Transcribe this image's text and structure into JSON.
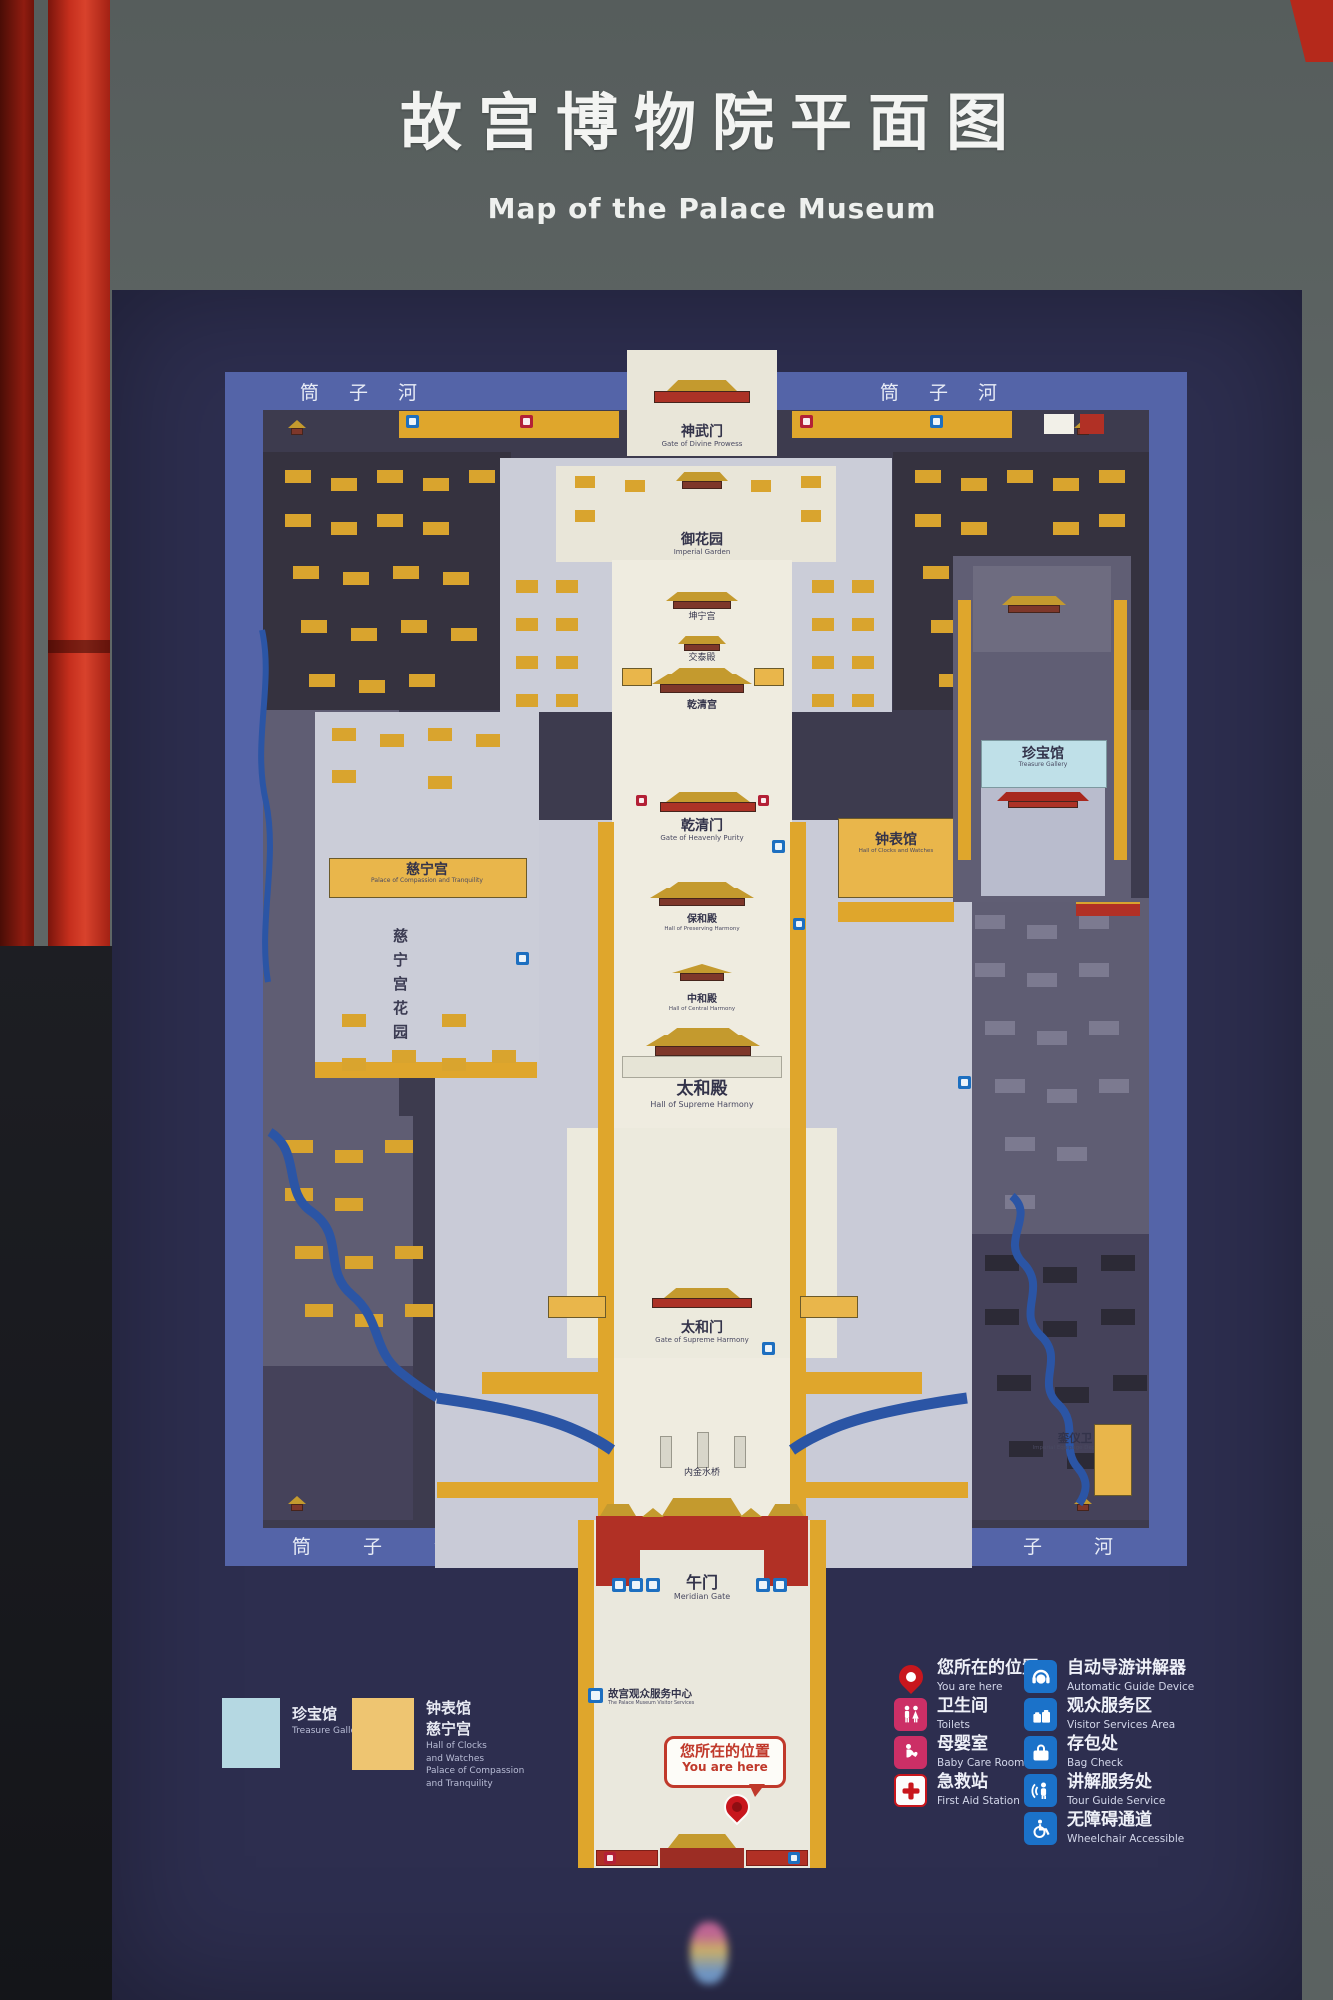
{
  "title": {
    "zh": "故宫博物院平面图",
    "en": "Map of the Palace Museum"
  },
  "moat_label": "筒子河",
  "map": {
    "labels": {
      "shenwumen": {
        "zh": "神武门",
        "en": "Gate of Divine Prowess"
      },
      "yuhuayuan": {
        "zh": "御花园",
        "en": "Imperial Garden"
      },
      "kunninggong": {
        "zh": "坤宁宫"
      },
      "jiaotaidian": {
        "zh": "交泰殿"
      },
      "qianqinggong": {
        "zh": "乾清宫"
      },
      "qianqingmen": {
        "zh": "乾清门",
        "en": "Gate of Heavenly Purity"
      },
      "baohedian": {
        "zh": "保和殿",
        "en": "Hall of Preserving Harmony"
      },
      "zhonghedian": {
        "zh": "中和殿",
        "en": "Hall of Central Harmony"
      },
      "taihedian": {
        "zh": "太和殿",
        "en": "Hall of Supreme Harmony"
      },
      "taihemen": {
        "zh": "太和门",
        "en": "Gate of Supreme Harmony"
      },
      "neijinshuiqiao": {
        "zh": "内金水桥"
      },
      "wumen": {
        "zh": "午门",
        "en": "Meridian Gate"
      },
      "zhenbaoguan": {
        "zh": "珍宝馆",
        "en": "Treasure Gallery"
      },
      "zhongbiaoguan": {
        "zh": "钟表馆",
        "en": "Hall of Clocks and Watches"
      },
      "cininggong": {
        "zh": "慈宁宫",
        "en": "Palace of Compassion and Tranquility"
      },
      "cining_garden": {
        "zh": "慈宁宫花园"
      },
      "luanyiwei": {
        "zh": "銮仪卫",
        "en": "Imperial Equipage Department"
      },
      "visitor_center": {
        "zh": "故宫观众服务中心",
        "en": "The Palace Museum Visitor Services"
      }
    },
    "you_are_here": {
      "zh": "您所在的位置",
      "en": "You are here"
    }
  },
  "legend_swatches": [
    {
      "zh": "珍宝馆",
      "en": "Treasure Gallery",
      "color": "#b5d8e2"
    },
    {
      "zh1": "钟表馆",
      "zh2": "慈宁宫",
      "en1": "Hall of Clocks",
      "en2": "and Watches",
      "en3": "Palace of Compassion",
      "en4": "and Tranquility",
      "color": "#eec571"
    }
  ],
  "legend_items_left": [
    {
      "zh": "您所在的位置",
      "en": "You are here",
      "icon": "location-pin",
      "color": "#c8161d"
    },
    {
      "zh": "卫生间",
      "en": "Toilets",
      "icon": "toilets",
      "color": "#cc2f66"
    },
    {
      "zh": "母婴室",
      "en": "Baby Care Room",
      "icon": "baby-care",
      "color": "#cc2f66"
    },
    {
      "zh": "急救站",
      "en": "First Aid Station",
      "icon": "first-aid",
      "color": "#c8161d"
    }
  ],
  "legend_items_right": [
    {
      "zh": "自动导游讲解器",
      "en": "Automatic Guide Device",
      "icon": "audio-guide",
      "color": "#1b72c9"
    },
    {
      "zh": "观众服务区",
      "en": "Visitor Services Area",
      "icon": "visitor-services",
      "color": "#1b72c9"
    },
    {
      "zh": "存包处",
      "en": "Bag Check",
      "icon": "bag-check",
      "color": "#1b72c9"
    },
    {
      "zh": "讲解服务处",
      "en": "Tour Guide Service",
      "icon": "tour-guide",
      "color": "#1b72c9"
    },
    {
      "zh": "无障碍通道",
      "en": "Wheelchair Accessible",
      "icon": "wheelchair",
      "color": "#1b72c9"
    }
  ],
  "colors": {
    "board_navy": "#2d2e4f",
    "moat_blue": "#5464a8",
    "route_gold": "#dfa62c",
    "river_blue": "#2b55a5",
    "treasure_blue": "#bfe0e8",
    "clocks_orange": "#e9b64b",
    "frame_red": "#c62f1d",
    "legend_blue": "#1b72c9",
    "legend_pink": "#cc2f66"
  }
}
